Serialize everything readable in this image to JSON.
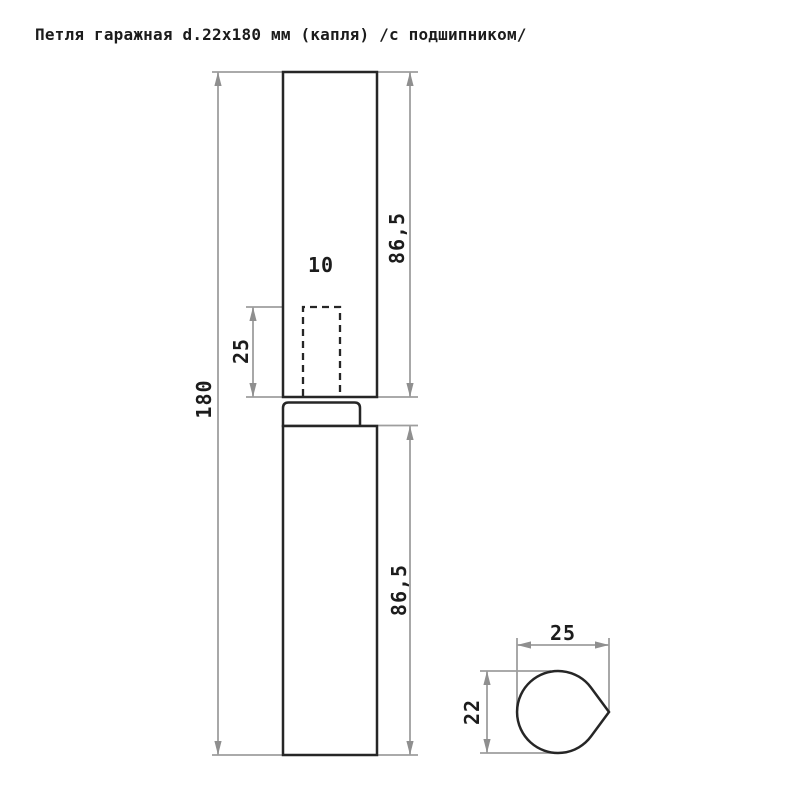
{
  "title": "Петля гаражная d.22x180 мм (капля) /с подшипником/",
  "dimensions": {
    "total_length": "180",
    "upper_leaf": "86,5",
    "lower_leaf": "86,5",
    "pin_hole_width": "10",
    "pin_hole_depth": "25",
    "section_width": "25",
    "section_height": "22"
  },
  "colors": {
    "outline": "#262626",
    "dimension_lines": "#9e9e9e",
    "arrows": "#8f8f8f",
    "text": "#1c1c1c",
    "background": "#ffffff"
  }
}
